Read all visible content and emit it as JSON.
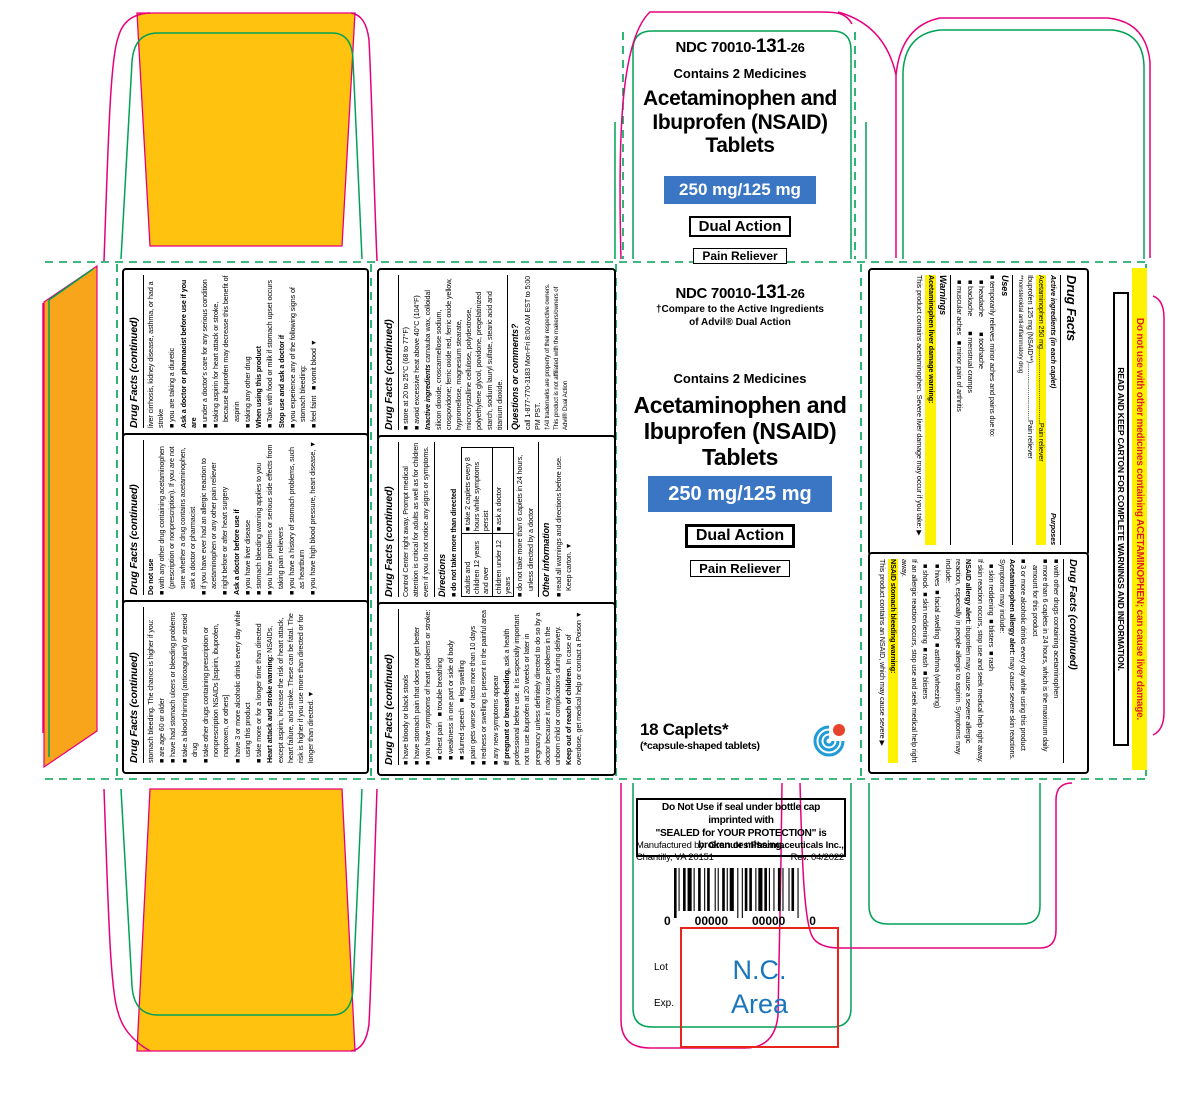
{
  "colors": {
    "orange_flap": "#FFC20E",
    "orange_strip": "#F9A51C",
    "dieline_magenta": "#E6007E",
    "dieline_green": "#00A155",
    "strength_blue": "#3B76C5",
    "highlight_yellow": "#FFF200",
    "warning_red": "#E31E24",
    "nc_red": "#E8251D",
    "nc_blue": "#1B75BB",
    "logo_blue": "#1E9CD7",
    "logo_red": "#E8432E"
  },
  "product": {
    "ndc_prefix": "NDC 70010-",
    "ndc_mid": "131",
    "ndc_suffix": "-26",
    "contains": "Contains 2 Medicines",
    "title1": "Acetaminophen and",
    "title2": "Ibuprofen (NSAID)",
    "title3": "Tablets",
    "strength": "250 mg/125 mg",
    "badge_dual": "Dual Action",
    "badge_pain": "Pain Reliever",
    "compare1": "†Compare to the Active Ingredients",
    "compare2": "of Advil® Dual Action",
    "count": "18 Caplets*",
    "count_note": "(*capsule-shaped tablets)"
  },
  "bottom_panel": {
    "tamper1": "Do Not Use if seal under bottle cap imprinted with",
    "tamper2": "\"SEALED for YOUR PROTECTION\" is broken or missing.",
    "mfg_prefix": "Manufactured by: ",
    "mfg_name": "Granules Pharmaceuticals Inc.,",
    "mfg_city": "Chantilly, VA 20151",
    "rev": "Rev. 04/2022",
    "barcode_d1": "0",
    "barcode_d2": "00000",
    "barcode_d3": "00000",
    "barcode_d4": "0",
    "lot": "Lot",
    "exp": "Exp.",
    "nc1": "N.C.",
    "nc2": "Area"
  },
  "right_flap": {
    "warning": "Do not use with other medicines containing ACETAMINOPHEN; can cause liver damage.",
    "read_keep": "READ AND KEEP CARTON FOR COMPLETE WARNINGS AND INFORMATION."
  },
  "panels": {
    "R1": {
      "lines": [
        {
          "t": "Drug Facts",
          "c": "h hbig"
        },
        {
          "cols": [
            "Active ingredients (in each caplet)",
            "Purposes"
          ]
        },
        {
          "t": "Acetaminophen 250 mg.......................................Pain reliever",
          "c": "n hl"
        },
        {
          "t": "Ibuprofen 125 mg (NSAID**)..............................Pain reliever",
          "c": "n"
        },
        {
          "t": "**nonsteroidal anti-inflammatory drug",
          "c": "sm"
        },
        {
          "t": "Uses",
          "c": "s"
        },
        {
          "t": "■ temporarily relieves minor aches and pains due to:",
          "c": "bu"
        },
        {
          "t": "■ headache        ■ toothache",
          "c": "bu in"
        },
        {
          "t": "■ backache        ■ menstrual cramps",
          "c": "bu in"
        },
        {
          "t": "■ muscular aches   ■ minor pain of arthritis",
          "c": "bu in"
        },
        {
          "t": "Warnings",
          "c": "s"
        },
        {
          "t": "Acetaminophen liver damage warning:",
          "c": "b hl"
        },
        {
          "t": "This product contains acetaminophen. Severe liver damage may occur if you take: ▶",
          "c": "n"
        }
      ]
    },
    "R2": {
      "lines": [
        {
          "t": "Drug Facts (continued)",
          "c": "h"
        },
        {
          "t": "■ with other drugs containing acetaminophen",
          "c": "bu"
        },
        {
          "t": "■ more than 6 caplets in 24 hours, which is the maximum daily amount for this product",
          "c": "bu"
        },
        {
          "t": "■ 3 or more alcoholic drinks every day while using this product",
          "c": "bu"
        },
        {
          "t": "Acetaminophen allergy alert: may cause severe skin reactions. Symptoms may include:",
          "c": "n",
          "lead": "Acetaminophen allergy alert:"
        },
        {
          "t": "■ skin reddening  ■ blisters  ■ rash",
          "c": "bu in"
        },
        {
          "t": "If skin reaction occurs, stop use and seek medical help right away.",
          "c": "n"
        },
        {
          "t": "NSAID allergy alert: ibuprofen may cause a severe allergic reaction, especially in people allergic to aspirin. Symptoms may include:",
          "c": "n",
          "lead": "NSAID allergy alert:"
        },
        {
          "t": "■ hives  ■ facial swelling  ■ asthma (wheezing)",
          "c": "bu in"
        },
        {
          "t": "■ shock  ■ skin reddening  ■ rash  ■ blisters",
          "c": "bu in"
        },
        {
          "t": "If an allergic reaction occurs, stop use and seek medical help right away.",
          "c": "n"
        },
        {
          "t": "NSAID stomach bleeding warning:",
          "c": "b hl"
        },
        {
          "t": "This product contains an NSAID, which may cause severe ▶",
          "c": "n"
        }
      ]
    },
    "L1": {
      "lines": [
        {
          "t": "Drug Facts (continued)",
          "c": "h"
        },
        {
          "t": "liver cirrhosis, kidney disease, asthma, or had a stroke",
          "c": "n"
        },
        {
          "t": "■ you are taking a diuretic",
          "c": "bu"
        },
        {
          "t": "Ask a doctor or pharmacist before use if you are",
          "c": "b"
        },
        {
          "t": "■ under a doctor's care for any serious condition",
          "c": "bu"
        },
        {
          "t": "■ taking aspirin for heart attack or stroke, because ibuprofen may decrease this benefit of aspirin",
          "c": "bu"
        },
        {
          "t": "■ taking any other drug",
          "c": "bu"
        },
        {
          "t": "When using this product",
          "c": "b"
        },
        {
          "t": "■ Take with food or milk if stomach upset occurs",
          "c": "bu"
        },
        {
          "t": "Stop use and ask a doctor if",
          "c": "b"
        },
        {
          "t": "■ you experience any of the following signs of stomach bleeding:",
          "c": "bu"
        },
        {
          "t": "■ feel faint   ■ vomit blood ▼",
          "c": "bu"
        }
      ]
    },
    "L2": {
      "lines": [
        {
          "t": "Drug Facts (continued)",
          "c": "h"
        },
        {
          "t": "Do not use",
          "c": "b"
        },
        {
          "t": "■ with any other drug containing acetaminophen (prescription or nonprescription). If you are not sure whether a drug contains acetaminophen, ask a doctor or pharmacist",
          "c": "bu"
        },
        {
          "t": "■ if you have ever had an allergic reaction to acetaminophen or any other pain reliever",
          "c": "bu"
        },
        {
          "t": "■ right before or after heart surgery",
          "c": "bu"
        },
        {
          "t": "Ask a doctor before use if",
          "c": "b"
        },
        {
          "t": "■ you have liver disease",
          "c": "bu"
        },
        {
          "t": "■ stomach bleeding warning applies to you",
          "c": "bu"
        },
        {
          "t": "■ you have problems or serious side effects from taking pain relievers",
          "c": "bu"
        },
        {
          "t": "■ you have a history of stomach problems, such as heartburn",
          "c": "bu"
        },
        {
          "t": "■ you have high blood pressure, heart disease, ▼",
          "c": "bu"
        }
      ]
    },
    "L3": {
      "lines": [
        {
          "t": "Drug Facts (continued)",
          "c": "h"
        },
        {
          "t": "stomach bleeding. The chance is higher if you:",
          "c": "n"
        },
        {
          "t": "■ are age 60 or older",
          "c": "bu"
        },
        {
          "t": "■ have had stomach ulcers or bleeding problems",
          "c": "bu"
        },
        {
          "t": "■ take a blood thinning (anticoagulant) or steroid drug",
          "c": "bu"
        },
        {
          "t": "■ take other drugs containing prescription or nonprescription NSAIDs [aspirin, ibuprofen, naproxen, or others]",
          "c": "bu"
        },
        {
          "t": "■ have 3 or more alcoholic drinks every day while using this product",
          "c": "bu"
        },
        {
          "t": "■ take more or for a longer time than directed",
          "c": "bu"
        },
        {
          "t": "Heart attack and stroke warning: NSAIDs, except aspirin, increase the risk of heart attack, heart failure, and stroke. These can be fatal. The risk is higher if you use more than directed or for longer than directed. ▼",
          "c": "n",
          "lead": "Heart attack and stroke warning:"
        }
      ]
    },
    "M1": {
      "lines": [
        {
          "t": "Drug Facts (continued)",
          "c": "h"
        },
        {
          "t": "■ store at 20 to 25°C (68 to 77°F)",
          "c": "bu"
        },
        {
          "t": "■ avoid excessive heat above 40°C (104°F)",
          "c": "bu"
        },
        {
          "t": "Inactive ingredients carnauba wax, colloidal silicon dioxide, croscarmellose sodium, crospovidone; ferric oxide red, ferric oxide yellow, hypromellose, magnesium stearate, microcrystalline cellulose, polydextrose, polyethylene glycol, povidone, pregelatinized starch, sodium lauryl sulfate, stearic acid and titanium dioxide.",
          "c": "n",
          "lead": "Inactive ingredients",
          "leadi": true
        },
        {
          "t": "Questions or comments?",
          "c": "s"
        },
        {
          "t": "call 1-877-770-3183 Mon-Fri 8:00 AM EST to 5:00 PM PST.",
          "c": "n"
        },
        {
          "t": "†All trademarks are property of their respective owners. This product is not affiliated with the makers/owners of Advil® Dual Action",
          "c": "sm"
        }
      ]
    },
    "M2": {
      "lines": [
        {
          "t": "Drug Facts (continued)",
          "c": "h"
        },
        {
          "t": "Control Center right away. Prompt medical attention is critical for adults as well as for children even if you do not notice any signs or symptoms.",
          "c": "n"
        },
        {
          "t": "Directions",
          "c": "s"
        },
        {
          "t": "■ do not take more than directed",
          "c": "bu b"
        },
        {
          "table": [
            [
              "adults and children 12 years and over",
              "■ take 2 caplets every 8 hours while symptoms persist"
            ],
            [
              "children under 12 years",
              "■ ask a doctor"
            ]
          ]
        },
        {
          "t": "■ do not take more than 6 caplets in 24 hours, unless directed by a doctor",
          "c": "bu"
        },
        {
          "t": "Other information",
          "c": "s"
        },
        {
          "t": "■ read all warnings and directions before use. Keep carton. ▼",
          "c": "bu"
        }
      ]
    },
    "M3": {
      "lines": [
        {
          "t": "Drug Facts (continued)",
          "c": "h"
        },
        {
          "t": "■ have bloody or black stools",
          "c": "bu"
        },
        {
          "t": "■ have stomach pain that does not get better",
          "c": "bu"
        },
        {
          "t": "■ you have symptoms of heart problems or stroke:",
          "c": "bu"
        },
        {
          "t": "■ chest pain   ■ trouble breathing",
          "c": "bu in"
        },
        {
          "t": "■ weakness in one part or side of body",
          "c": "bu in"
        },
        {
          "t": "■ slurred speech   ■ leg swelling",
          "c": "bu in"
        },
        {
          "t": "■ pain gets worse or lasts more than 10 days",
          "c": "bu"
        },
        {
          "t": "■ redness or swelling is present in the painful area",
          "c": "bu"
        },
        {
          "t": "■ any new symptoms appear",
          "c": "bu"
        },
        {
          "t": "If pregnant or breast-feeding, ask a health professional before use. It is especially important not to use ibuprofen at 20 weeks or later in pregnancy unless definitely directed to do so by a doctor because it may cause problems in the unborn child or complications during delivery.",
          "c": "n",
          "lead": "If pregnant or breast-feeding,"
        },
        {
          "t": "Keep out of reach of children. In case of overdose, get medical help or contact a Poison ▼",
          "c": "n",
          "lead": "Keep out of reach of children."
        }
      ]
    }
  }
}
